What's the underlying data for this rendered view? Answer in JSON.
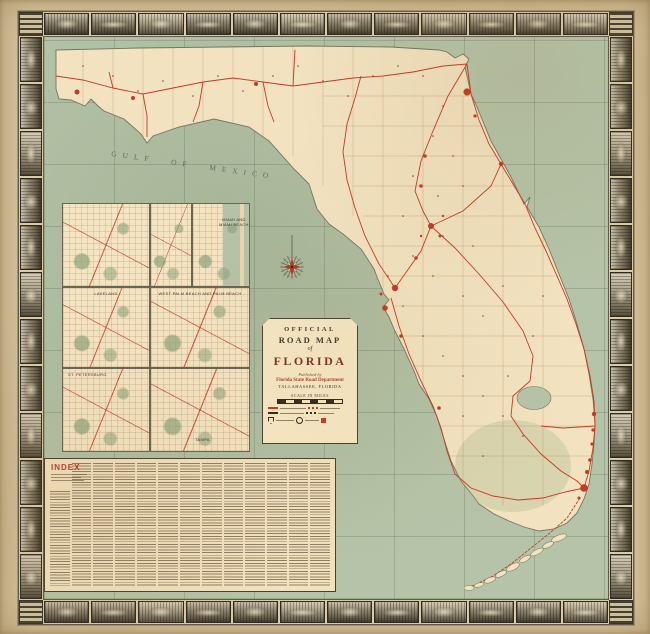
{
  "page": {
    "alt": "Official Road Map of Florida - vintage folded highway map with pictorial border"
  },
  "cartouche": {
    "line_official": "OFFICIAL",
    "line_road_map": "ROAD MAP",
    "line_of": "of",
    "line_state": "FLORIDA",
    "published_by": "Published by",
    "publisher": "Florida State Road Department",
    "publisher_city": "TALLAHASSEE, FLORIDA",
    "scale_label": "SCALE IN MILES"
  },
  "index_panel": {
    "title": "INDEX",
    "column_count": 13
  },
  "map": {
    "gulf_label": "GULF OF MEXICO"
  },
  "insets": [
    {
      "title": ""
    },
    {
      "title": ""
    },
    {
      "title": "MIAMI AND MIAMI BEACH"
    },
    {
      "title": "LAKELAND"
    },
    {
      "title": "WEST PALM BEACH AND PALM BEACH"
    },
    {
      "title": "ST. PETERSBURG"
    },
    {
      "title": "TAMPA"
    }
  ],
  "border": {
    "top_cells": 12,
    "bottom_cells": 12,
    "left_cells": 12,
    "right_cells": 12
  },
  "colors": {
    "paper": "#d8c6a1",
    "land": "#f2e2c0",
    "water": "#b5c3a8",
    "road_red": "#c23b22",
    "ink": "#3c382c",
    "index_red": "#c0392b"
  }
}
